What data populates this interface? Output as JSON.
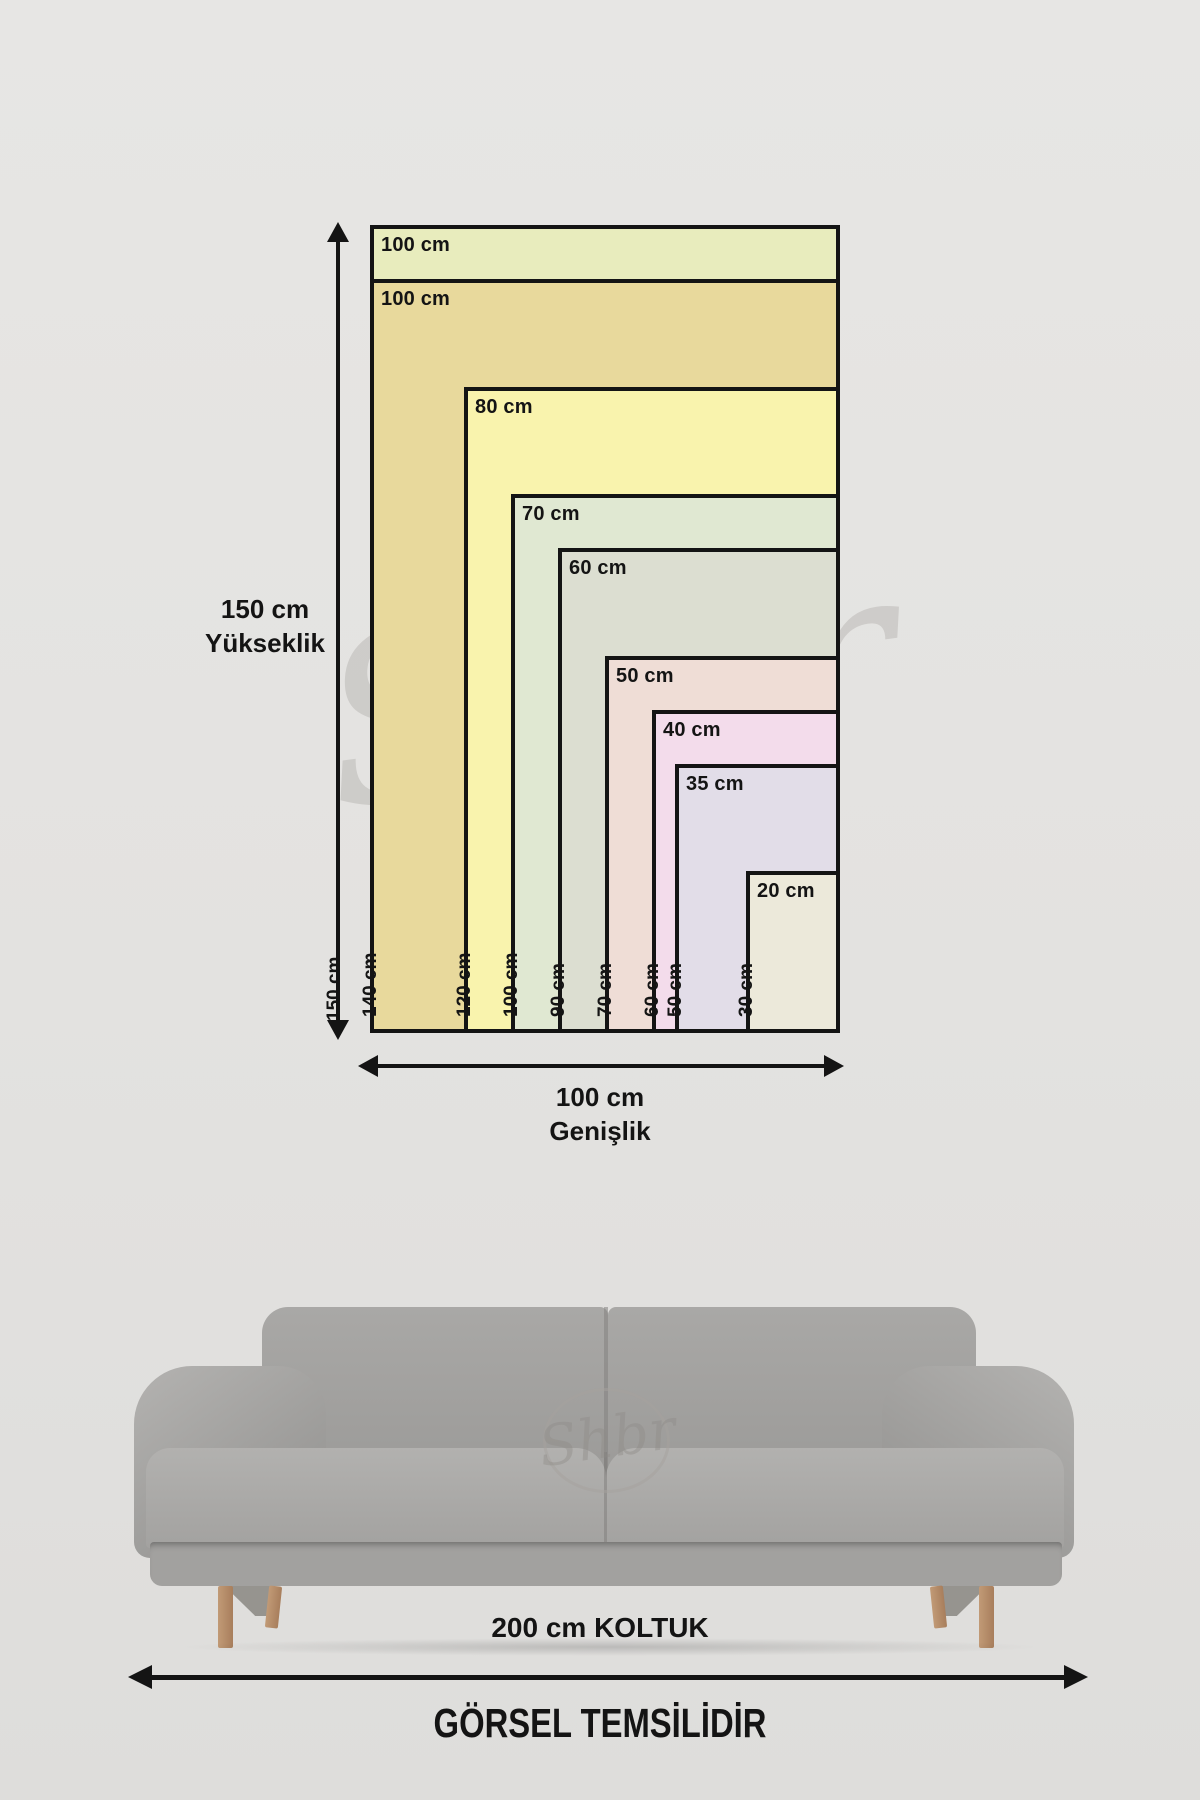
{
  "watermark": {
    "text": "Shbr"
  },
  "diagram": {
    "border_color": "#141414",
    "height_axis": {
      "value": "150 cm",
      "label": "Yükseklik"
    },
    "width_axis": {
      "value": "100 cm",
      "label": "Genişlik"
    },
    "sizes": [
      {
        "width_cm": 100,
        "height_cm": 150,
        "width_label": "100 cm",
        "height_label": "150 cm",
        "color": "#e8ecbd",
        "height_label_outside": true
      },
      {
        "width_cm": 100,
        "height_cm": 140,
        "width_label": "100 cm",
        "height_label": "140 cm",
        "color": "#e8d99c"
      },
      {
        "width_cm": 80,
        "height_cm": 120,
        "width_label": "80 cm",
        "height_label": "120 cm",
        "color": "#f9f3ad"
      },
      {
        "width_cm": 70,
        "height_cm": 100,
        "width_label": "70 cm",
        "height_label": "100 cm",
        "color": "#e0e8d2"
      },
      {
        "width_cm": 60,
        "height_cm": 90,
        "width_label": "60 cm",
        "height_label": "90 cm",
        "color": "#dcded1"
      },
      {
        "width_cm": 50,
        "height_cm": 70,
        "width_label": "50 cm",
        "height_label": "70 cm",
        "color": "#efddd6"
      },
      {
        "width_cm": 40,
        "height_cm": 60,
        "width_label": "40 cm",
        "height_label": "60 cm",
        "color": "#f3dceb"
      },
      {
        "width_cm": 35,
        "height_cm": 50,
        "width_label": "35 cm",
        "height_label": "50 cm",
        "color": "#e2dde8"
      },
      {
        "width_cm": 20,
        "height_cm": 30,
        "width_label": "20 cm",
        "height_label": "30 cm",
        "color": "#ece9da"
      }
    ]
  },
  "sofa": {
    "caption": "200 cm KOLTUK"
  },
  "footer": {
    "notice": "GÖRSEL TEMSİLİDİR"
  }
}
